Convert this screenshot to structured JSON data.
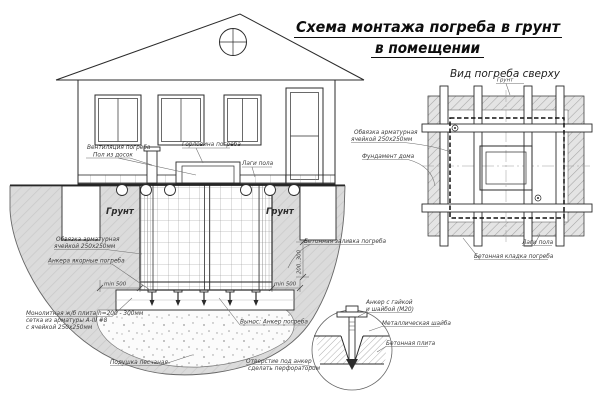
{
  "title": {
    "line1": "Схема монтажа погреба в грунт",
    "line2": "в помещении"
  },
  "section": {
    "vent_line1": "Вентиляция погреба",
    "vent_line2": "Пол из досок",
    "neck_label": "Горловина погреба",
    "joists_label": "Лаги пола",
    "soil_left": "Грунт",
    "soil_right": "Грунт",
    "binding_line1": "Обвязка арматурная",
    "binding_line2": "ячейкой 250х250мм",
    "anchors_label": "Анкера якорные погреба",
    "slab_line1": "Монолитная ж/б плита h=200 - 300мм",
    "slab_line2": "сетка из арматуры А-III #8",
    "slab_line3": "с ячейкой 250х250мм",
    "sand_label": "Подушка песчаная",
    "pour_label": "Бетонная заливка погреба",
    "callout_label": "Вынос: Анкер погреба",
    "dim_min500": "min 500",
    "dim_depth": "200..300"
  },
  "plan": {
    "title": "Вид погреба сверху",
    "soil_label": "Грунт",
    "binding_line1": "Обвязка арматурная",
    "binding_line2": "ячейкой 250х250мм",
    "foundation_label": "Фундамент дома",
    "joists_label": "Лаги пола",
    "masonry_label": "Бетонная кладка погреба"
  },
  "detail": {
    "anchor_line1": "Анкер с гайкой",
    "anchor_line2": "и шайбой (М20)",
    "washer_label": "Металлическая шайба",
    "plate_label": "Бетонная плита",
    "hole_line1": "Отверстие под анкер",
    "hole_line2": "сделать перфоратором"
  },
  "colors": {
    "ink": "#2b2b2b",
    "soil_fill": "#dbdbdb",
    "hatch": "#c9c9c9"
  }
}
